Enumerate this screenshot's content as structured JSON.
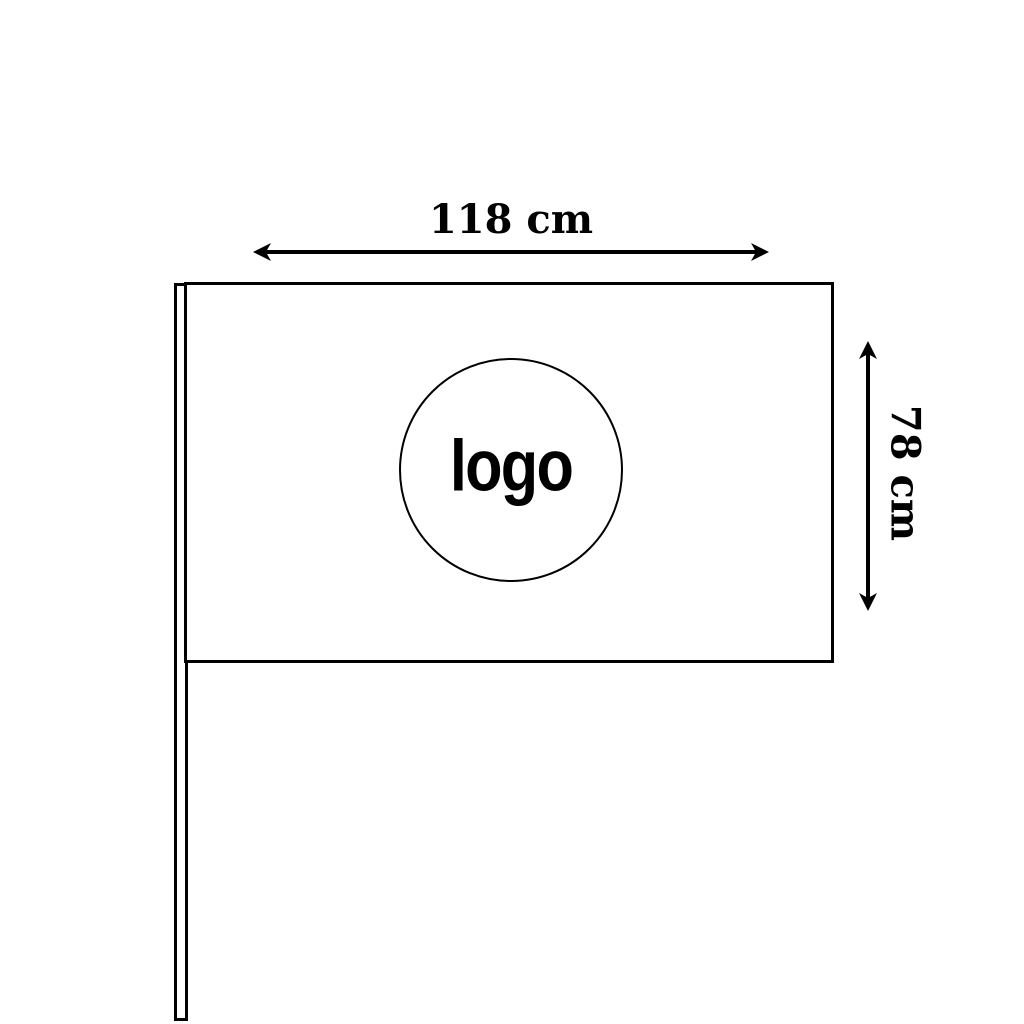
{
  "diagram": {
    "flag": {
      "width_label": "118 cm",
      "height_label": "78 cm"
    },
    "logo": {
      "label": "logo"
    },
    "colors": {
      "line": "#000000",
      "background": "#ffffff"
    }
  }
}
